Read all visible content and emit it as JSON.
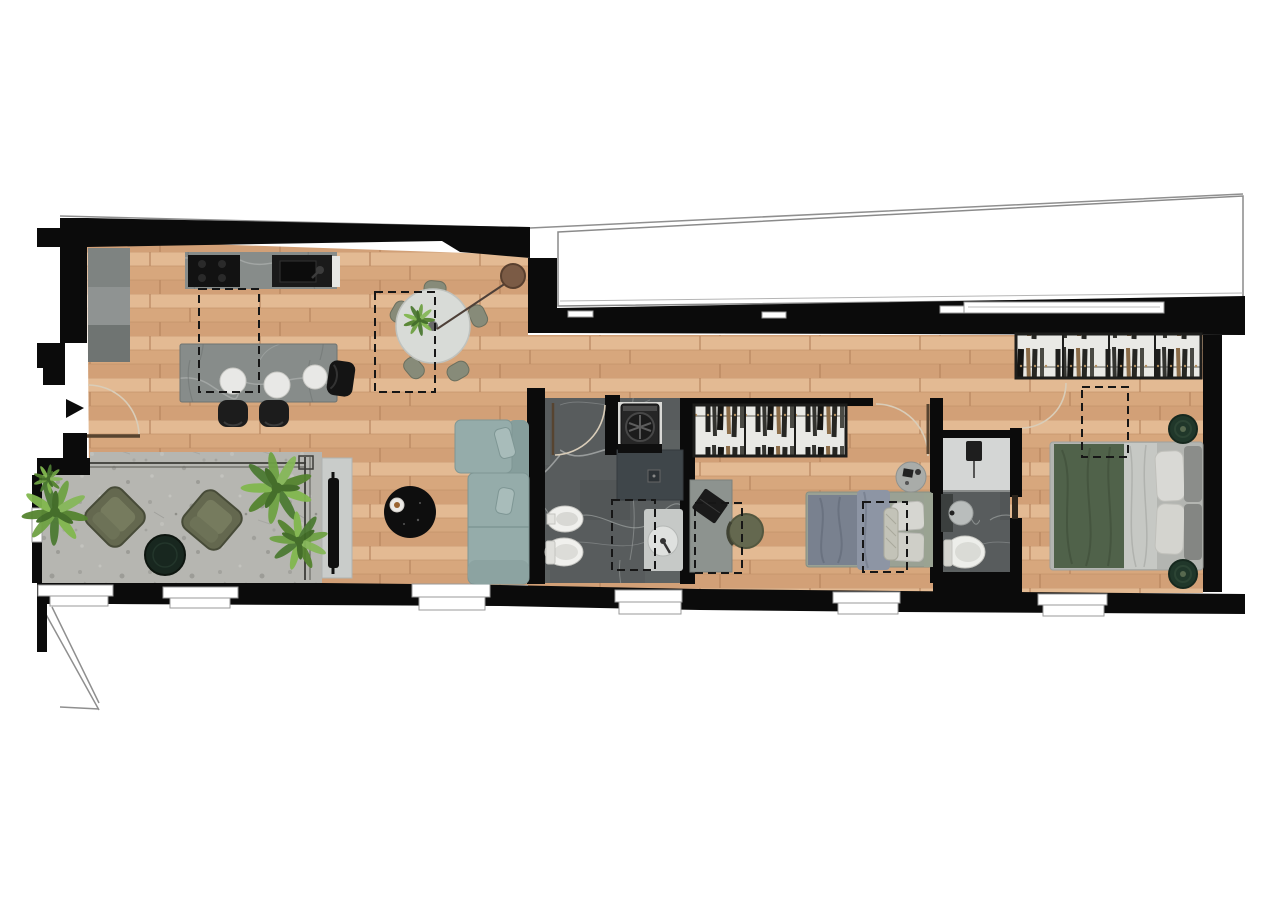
{
  "document": {
    "type": "apartment-floor-plan-render",
    "view": "top-down"
  },
  "colors": {
    "background": "#ffffff",
    "walls": "#0b0b0b",
    "outline": "#8f8f8f",
    "wood_base": "#ddb189",
    "stone": "#b6b6b1",
    "marble_dark": "#585c5d",
    "marble_light": "#878c8a",
    "shower_dark": "#3f464a",
    "shower_light": "#d4d6d5",
    "cabinet_gray": "#7e8381",
    "sofa": "#95acaa",
    "sofa_back": "#869e9c",
    "armchair": "#64684f",
    "terrace_table": "#18271f",
    "coffee_table": "#0e0e0e",
    "tv_unit": "#c9ccca",
    "tv_black": "#0f0f0f",
    "dining_table": "#d8dbd7",
    "chair_olive": "#878b79",
    "pendant_brown": "#7b5b45",
    "bed2_blanket": "#79818f",
    "bed2_drape": "#8d95a4",
    "pillow_white": "#d6d6d1",
    "headboard2": "#9aa392",
    "master_duvet": "#50624a",
    "master_sheet": "#c6c8c4",
    "headboard_master": "#8b8d8a",
    "pouf_green": "#20372a",
    "plant_dark": "#55842f",
    "plant_light": "#82b84f",
    "wardrobe_bg": "#e9e9e5",
    "appliance_black": "#262626",
    "fixture_white": "#f0f0ed",
    "dash": "#161616",
    "door_arc": "#d9cdb9",
    "door_leaf": "#574430",
    "window_frame": "#9a9a9a"
  },
  "rooms": [
    {
      "name": "kitchen"
    },
    {
      "name": "dining-area"
    },
    {
      "name": "living-room"
    },
    {
      "name": "terrace"
    },
    {
      "name": "bathroom-1"
    },
    {
      "name": "laundry-niche"
    },
    {
      "name": "hallway"
    },
    {
      "name": "bedroom-2"
    },
    {
      "name": "bathroom-2"
    },
    {
      "name": "master-bedroom"
    }
  ],
  "furniture": {
    "kitchen": [
      "wall-cabinets",
      "cooktop",
      "sink",
      "island-with-stools",
      "bar-chair"
    ],
    "dining": [
      "round-table",
      "five-chairs",
      "table-plant",
      "pendant-lamp"
    ],
    "living": [
      "corner-sofa",
      "round-coffee-table",
      "tv-sideboard"
    ],
    "terrace": [
      "two-armchairs",
      "round-side-table",
      "three-plants",
      "glass-railing"
    ],
    "bathroom_1": [
      "walk-in-shower",
      "vanity-basin",
      "toilet",
      "bidet",
      "washing-machine"
    ],
    "bedroom_2": [
      "wardrobe-3-sections",
      "desk-with-laptop",
      "chair",
      "single-bed",
      "bedside-table"
    ],
    "bathroom_2": [
      "shower",
      "basin",
      "toilet"
    ],
    "master_bedroom": [
      "wardrobe-4-sections",
      "double-bed",
      "two-green-poufs"
    ]
  },
  "annotations": {
    "entry_arrow": true,
    "door_swings": 5,
    "skylight_dashed_markers": 6,
    "bottom_windows": 6,
    "neighbor_volume_outline": true
  }
}
